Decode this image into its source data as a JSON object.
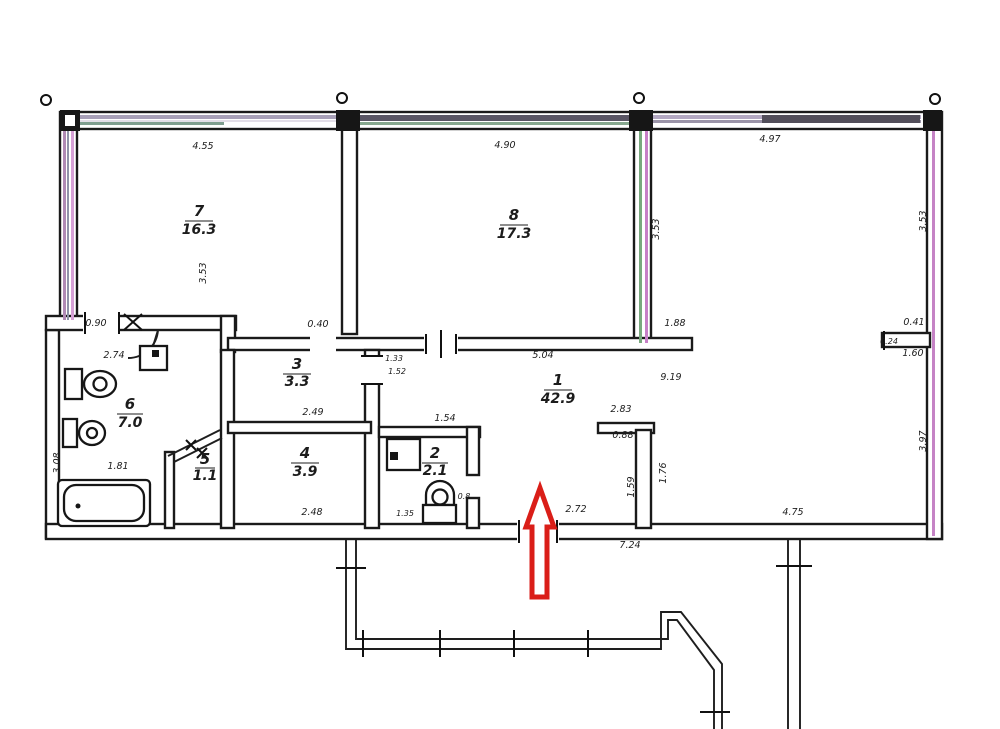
{
  "title": "apartment floor plan scan",
  "colors": {
    "arrow": "#da1e18",
    "wall": "#1a1a1a",
    "paper": "#ffffff"
  },
  "rooms": [
    {
      "number": "7",
      "area": "16.3"
    },
    {
      "number": "8",
      "area": "17.3"
    },
    {
      "number": "1",
      "area": "42.9"
    },
    {
      "number": "6",
      "area": "7.0"
    },
    {
      "number": "5",
      "area": "1.1"
    },
    {
      "number": "4",
      "area": "3.9"
    },
    {
      "number": "3",
      "area": "3.3"
    },
    {
      "number": "2",
      "area": "2.1"
    }
  ],
  "dims": {
    "h": [
      {
        "t": "4.55"
      },
      {
        "t": "4.90"
      },
      {
        "t": "4.97"
      },
      {
        "t": "0.90"
      },
      {
        "t": "2.74"
      },
      {
        "t": "0.40"
      },
      {
        "t": "5.04"
      },
      {
        "t": "9.19"
      },
      {
        "t": "1.88"
      },
      {
        "t": "0.41"
      },
      {
        "t": "0.24"
      },
      {
        "t": "1.60"
      },
      {
        "t": "2.49"
      },
      {
        "t": "1.54"
      },
      {
        "t": "2.83"
      },
      {
        "t": "0.88"
      },
      {
        "t": "1.81"
      },
      {
        "t": "2.48"
      },
      {
        "t": "1.35"
      },
      {
        "t": "2.72"
      },
      {
        "t": "4.75"
      },
      {
        "t": "7.24"
      },
      {
        "t": "1.33"
      },
      {
        "t": "1.52"
      },
      {
        "t": "0.8"
      }
    ],
    "v": [
      {
        "t": "3.53"
      },
      {
        "t": "3.53"
      },
      {
        "t": "3.53"
      },
      {
        "t": "3.97"
      },
      {
        "t": "3.08"
      },
      {
        "t": "1.59"
      },
      {
        "t": "1.76"
      }
    ]
  },
  "annotations": {
    "entrance_arrow": "entrance direction arrow"
  }
}
